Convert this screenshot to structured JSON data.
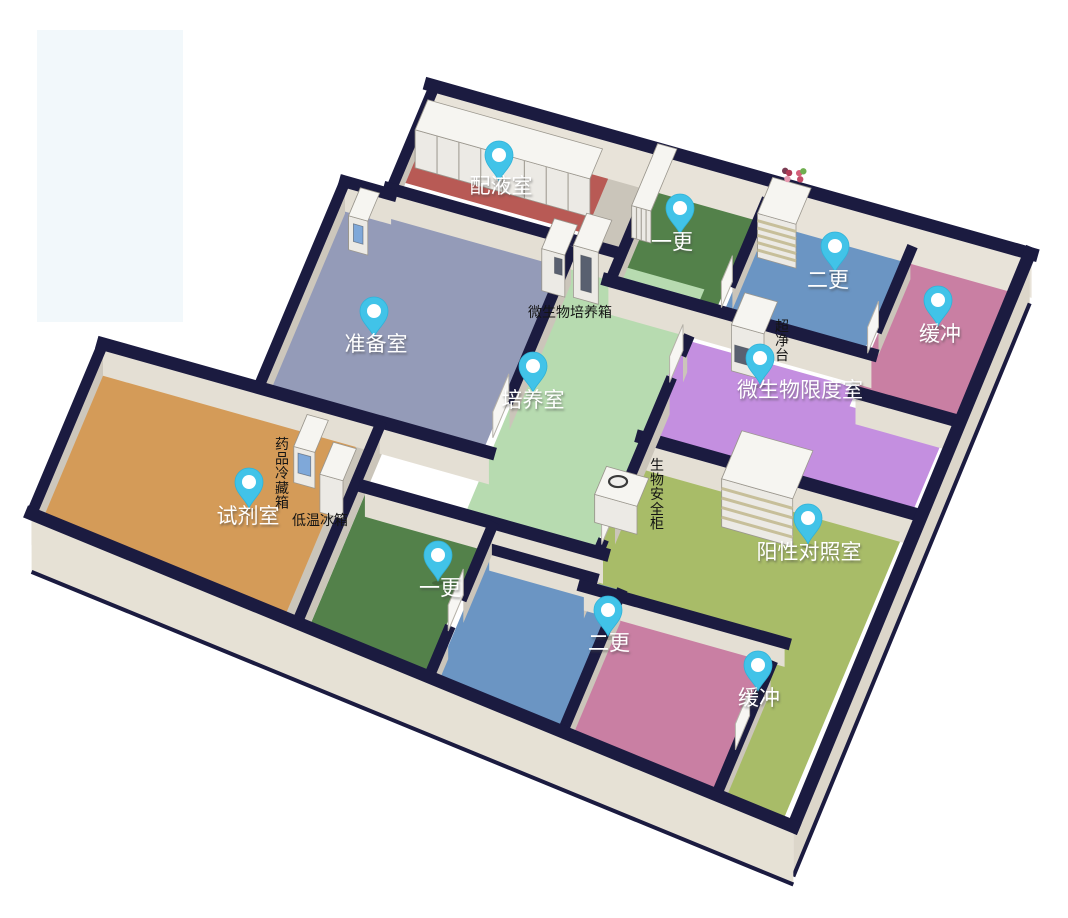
{
  "scene": {
    "background": "#ffffff",
    "watermark": {
      "x": 37,
      "y": 30,
      "w": 146,
      "h": 292,
      "color": "#f2f8fb"
    }
  },
  "palette": {
    "wall_top": "#1b1b40",
    "wall_face_cream": "#e8e3d9",
    "wall_face_inner": "#e4dfd4",
    "wall_face_gray": "#c9c3b8",
    "wall_face_gray2": "#cbc5ba",
    "wall_face_gray3": "#cdc7bc",
    "outer_face_east": "#dcd6ca",
    "outer_face_south": "#e6e1d5",
    "gap_floor": "#cac5ba",
    "equip_top": "#f6f5f1",
    "equip_front": "#eceae5",
    "equip_side": "#d8d5cd",
    "panel_blue": "#7fa8d9",
    "panel_dark": "#596070",
    "slat_tan": "#c7bf9a",
    "pin_fill": "#41c3e8",
    "pin_rim": "#2fb2d8",
    "pin_dot": "#ffffff"
  },
  "rooms": [
    {
      "id": "peiyeshi",
      "label": "配液室",
      "color": "#b85a55",
      "pin": {
        "x": 499,
        "y": 157
      },
      "label_pos": {
        "x": 501,
        "y": 193
      }
    },
    {
      "id": "yigeng-top",
      "label": "一更",
      "color": "#53814a",
      "pin": {
        "x": 680,
        "y": 210
      },
      "label_pos": {
        "x": 672,
        "y": 249
      }
    },
    {
      "id": "ergeng-top",
      "label": "二更",
      "color": "#6b95c3",
      "pin": {
        "x": 835,
        "y": 248
      },
      "label_pos": {
        "x": 828,
        "y": 287
      }
    },
    {
      "id": "huanchong-top",
      "label": "缓冲",
      "color": "#c97fa3",
      "pin": {
        "x": 938,
        "y": 302
      },
      "label_pos": {
        "x": 940,
        "y": 341
      }
    },
    {
      "id": "zhunbeishi",
      "label": "准备室",
      "color": "#949bb8",
      "pin": {
        "x": 374,
        "y": 313
      },
      "label_pos": {
        "x": 376,
        "y": 351
      }
    },
    {
      "id": "peiyangshi",
      "label": "培养室",
      "color": "#b7dbb0",
      "pin": {
        "x": 533,
        "y": 368
      },
      "label_pos": {
        "x": 533,
        "y": 407
      }
    },
    {
      "id": "weishengwu-xiandushi",
      "label": "微生物限度室",
      "color": "#c48fe0",
      "pin": {
        "x": 760,
        "y": 360
      },
      "label_pos": {
        "x": 800,
        "y": 397
      }
    },
    {
      "id": "shijishi",
      "label": "试剂室",
      "color": "#d49b58",
      "pin": {
        "x": 249,
        "y": 484
      },
      "label_pos": {
        "x": 248,
        "y": 523
      }
    },
    {
      "id": "yangxing-duizhaoshi",
      "label": "阳性对照室",
      "color": "#a8bc68",
      "pin": {
        "x": 808,
        "y": 520
      },
      "label_pos": {
        "x": 809,
        "y": 559
      }
    },
    {
      "id": "yigeng-bottom",
      "label": "一更",
      "color": "#53814a",
      "pin": {
        "x": 438,
        "y": 557
      },
      "label_pos": {
        "x": 440,
        "y": 595
      }
    },
    {
      "id": "ergeng-bottom",
      "label": "二更",
      "color": "#6b95c3",
      "pin": {
        "x": 608,
        "y": 612
      },
      "label_pos": {
        "x": 609,
        "y": 650
      }
    },
    {
      "id": "huanchong-bottom",
      "label": "缓冲",
      "color": "#c97fa3",
      "pin": {
        "x": 758,
        "y": 667
      },
      "label_pos": {
        "x": 759,
        "y": 705
      }
    }
  ],
  "equipment_labels": [
    {
      "id": "weishengwu-peiyangxiang",
      "text": "微生物培养箱",
      "x": 570,
      "y": 317,
      "orientation": "horizontal"
    },
    {
      "id": "chaojingtai",
      "text": "超净台",
      "x": 782,
      "y": 331,
      "orientation": "vertical"
    },
    {
      "id": "yaopin-lengcangxiang",
      "text": "药品冷藏箱",
      "x": 282,
      "y": 449,
      "orientation": "vertical"
    },
    {
      "id": "diwen-bingxiang",
      "text": "低温冰箱",
      "x": 320,
      "y": 525,
      "orientation": "horizontal"
    },
    {
      "id": "shengwu-anquangui",
      "text": "生物安全柜",
      "x": 657,
      "y": 470,
      "orientation": "vertical"
    }
  ]
}
